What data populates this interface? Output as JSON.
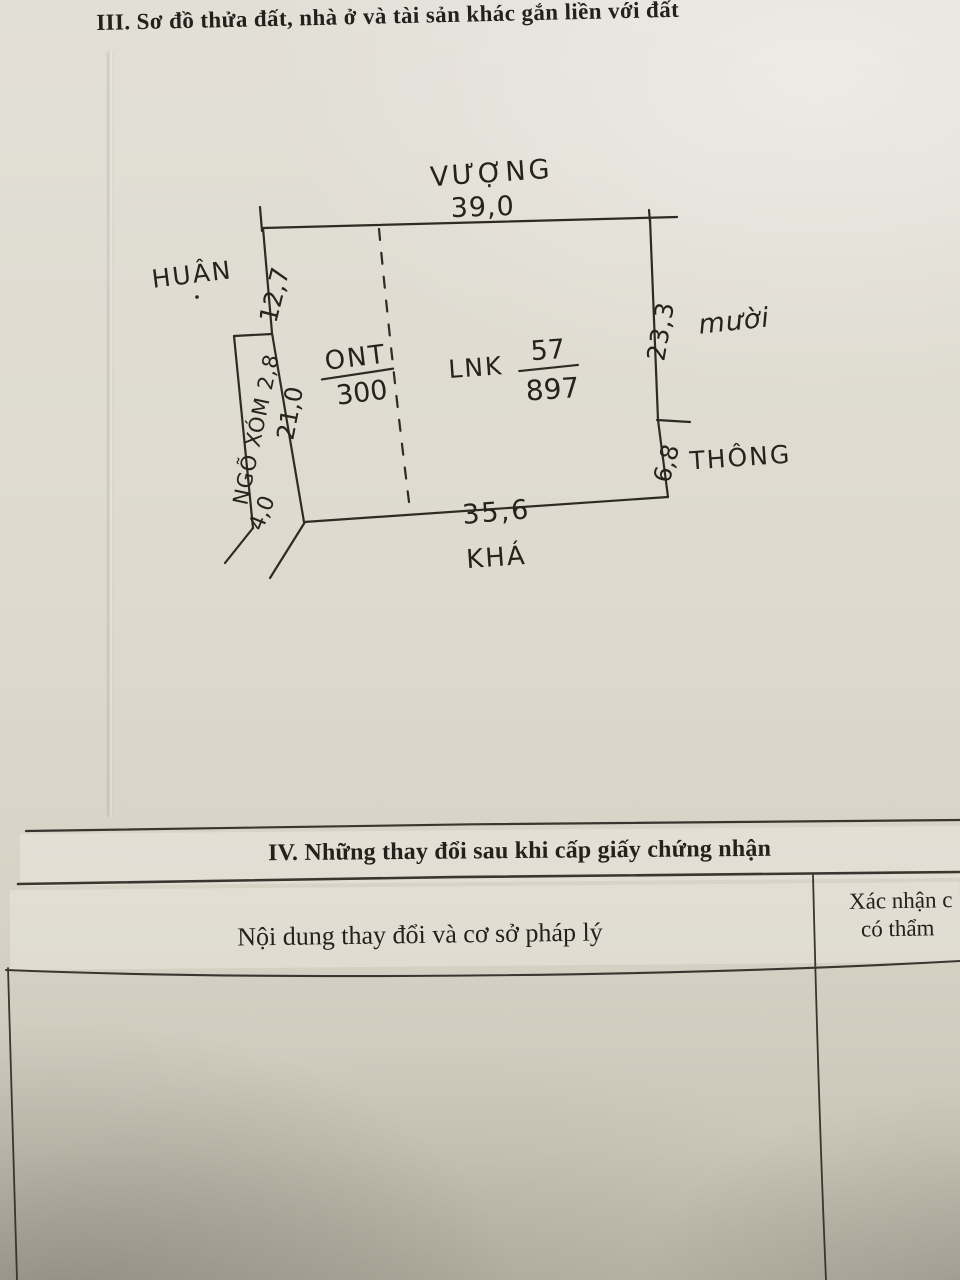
{
  "document": {
    "section_iii_title": "III. Sơ đồ thửa đất, nhà ở và tài sản khác gắn liền với đất",
    "section_iv_title": "IV. Những thay đổi sau khi cấp giấy chứng nhận"
  },
  "sketch": {
    "adjacent_names": {
      "top": "VƯỢNG",
      "left": "HUÂN",
      "right_upper": "mười",
      "right_lower": "THÔNG",
      "bottom": "KHÁ"
    },
    "dimensions": {
      "top": "39,0",
      "left_upper": "12,7",
      "left_lower": "21,0",
      "right_upper": "23,3",
      "right_lower": "6,8",
      "bottom": "35,6",
      "alley_bottom": "4,0"
    },
    "alley_label": "NGÕ XÓM 2,8",
    "parcels": {
      "left": {
        "land_use_code": "ONT",
        "area": "300"
      },
      "main": {
        "land_use_code": "LNK",
        "parcel_number": "57",
        "area": "897"
      }
    }
  },
  "changes_table": {
    "column1_header": "Nội dung thay đổi và cơ sở pháp lý",
    "column2_header_line1": "Xác nhận c",
    "column2_header_line2": "có thẩm"
  },
  "colors": {
    "paper": "#dcd8cd",
    "printed_ink": "#24211c",
    "hand_ink": "#26231d",
    "table_line": "#3a362f"
  }
}
